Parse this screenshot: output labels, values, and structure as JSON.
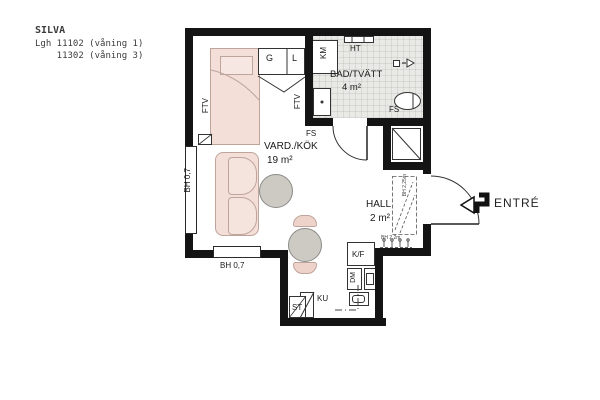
{
  "title_block": {
    "project": "SILVA",
    "line1": "Lgh 11102 (våning 1)",
    "line2": "    11302 (våning 3)"
  },
  "rooms": {
    "vardkok": {
      "name": "VARD./KÖK",
      "area": "19 m²"
    },
    "bad": {
      "name": "BAD/TVÄTT",
      "area": "4 m²"
    },
    "hall": {
      "name": "HALL",
      "area": "2 m²"
    }
  },
  "fixtures": {
    "g": "G",
    "l": "L",
    "km": "KM",
    "ht": "HT",
    "fs_bath": "FS",
    "fs_wall": "FS",
    "ftv_left": "FTV",
    "ftv_mid": "FTV",
    "kf": "K/F",
    "dm": "DM",
    "ku": "KU",
    "st": "ST"
  },
  "dimensions": {
    "window_left": "BH 0,7",
    "window_bottom": "BH 0,7",
    "hall_rail": "BH 2,25m",
    "hall_hooks": "BH 2,2m"
  },
  "entry": {
    "label": "ENTRÉ"
  },
  "colors": {
    "wall": "#141414",
    "furniture_fill": "#f3ded8",
    "furniture_line": "#bfa49c",
    "table_fill": "#cdcac4",
    "bath_floor": "#e9e9e6"
  }
}
